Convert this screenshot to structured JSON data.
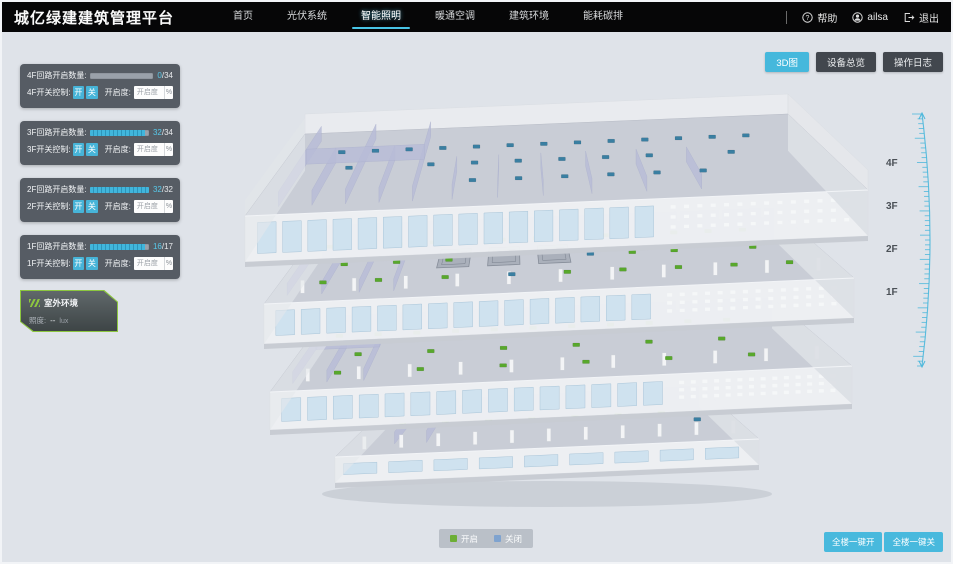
{
  "header": {
    "title": "城亿绿建建筑管理平台",
    "nav": [
      {
        "label": "首页",
        "active": false
      },
      {
        "label": "光伏系统",
        "active": false
      },
      {
        "label": "智能照明",
        "active": true
      },
      {
        "label": "暖通空调",
        "active": false
      },
      {
        "label": "建筑环境",
        "active": false
      },
      {
        "label": "能耗碳排",
        "active": false
      }
    ],
    "help_label": "帮助",
    "username": "ailsa",
    "logout_label": "退出"
  },
  "toolbar": {
    "view_3d": "3D图",
    "device_overview": "设备总览",
    "operation_log": "操作日志"
  },
  "floor_panels": [
    {
      "floor": "4F",
      "count_label": "4F回路开启数量:",
      "value": 0,
      "max": 34,
      "max_text": "/34",
      "switch_label": "4F开关控制:",
      "on_label": "开",
      "off_label": "关",
      "openness_label": "开启度:",
      "openness_placeholder": "开启度",
      "unit": "%"
    },
    {
      "floor": "3F",
      "count_label": "3F回路开启数量:",
      "value": 32,
      "max": 34,
      "max_text": "/34",
      "switch_label": "3F开关控制:",
      "on_label": "开",
      "off_label": "关",
      "openness_label": "开启度:",
      "openness_placeholder": "开启度",
      "unit": "%"
    },
    {
      "floor": "2F",
      "count_label": "2F回路开启数量:",
      "value": 32,
      "max": 32,
      "max_text": "/32",
      "switch_label": "2F开关控制:",
      "on_label": "开",
      "off_label": "关",
      "openness_label": "开启度:",
      "openness_placeholder": "开启度",
      "unit": "%"
    },
    {
      "floor": "1F",
      "count_label": "1F回路开启数量:",
      "value": 16,
      "max": 17,
      "max_text": "/17",
      "switch_label": "1F开关控制:",
      "on_label": "开",
      "off_label": "关",
      "openness_label": "开启度:",
      "openness_placeholder": "开启度",
      "unit": "%"
    }
  ],
  "outdoor": {
    "title": "室外环境",
    "illuminance_label": "照度:",
    "illuminance_value": "--",
    "illuminance_unit": "lux"
  },
  "floor_selector": [
    "4F",
    "3F",
    "2F",
    "1F"
  ],
  "legend": {
    "on_label": "开启",
    "off_label": "关闭",
    "on_color": "#6cae35",
    "off_color": "#7fa3cf"
  },
  "bulk_actions": {
    "all_on": "全楼一键开",
    "all_off": "全楼一键关"
  },
  "colors": {
    "accent": "#45b8dc",
    "header_bg": "#060607",
    "page_bg": "#dfe3e9",
    "panel_bg": "rgba(71,77,85,0.9)"
  },
  "building": {
    "light_on_color": "#58a82c",
    "light_off_color": "#3a7fa2",
    "floors": [
      {
        "name": "4F",
        "lights": [
          [
            0.1,
            0.75,
            0
          ],
          [
            0.165,
            0.75,
            0
          ],
          [
            0.23,
            0.75,
            0
          ],
          [
            0.295,
            0.75,
            0
          ],
          [
            0.36,
            0.75,
            0
          ],
          [
            0.425,
            0.75,
            0
          ],
          [
            0.49,
            0.75,
            0
          ],
          [
            0.555,
            0.75,
            0
          ],
          [
            0.62,
            0.75,
            0
          ],
          [
            0.685,
            0.75,
            0
          ],
          [
            0.75,
            0.75,
            0
          ],
          [
            0.815,
            0.75,
            0
          ],
          [
            0.88,
            0.75,
            0
          ],
          [
            0.13,
            0.55,
            0
          ],
          [
            0.28,
            0.55,
            0
          ],
          [
            0.36,
            0.55,
            0
          ],
          [
            0.44,
            0.55,
            0
          ],
          [
            0.52,
            0.55,
            0
          ],
          [
            0.6,
            0.55,
            0
          ],
          [
            0.68,
            0.55,
            0
          ],
          [
            0.83,
            0.55,
            0
          ],
          [
            0.36,
            0.33,
            0
          ],
          [
            0.44,
            0.33,
            0
          ],
          [
            0.52,
            0.33,
            0
          ],
          [
            0.6,
            0.33,
            0
          ],
          [
            0.68,
            0.33,
            0
          ],
          [
            0.76,
            0.33,
            0
          ]
        ]
      },
      {
        "name": "3F",
        "lights": [
          [
            0.05,
            0.72,
            1
          ],
          [
            0.12,
            0.72,
            1
          ],
          [
            0.19,
            0.72,
            1
          ],
          [
            0.26,
            0.72,
            1
          ],
          [
            0.33,
            0.72,
            1
          ],
          [
            0.4,
            0.72,
            1
          ],
          [
            0.47,
            0.72,
            1
          ],
          [
            0.54,
            0.72,
            1
          ],
          [
            0.61,
            0.72,
            1
          ],
          [
            0.68,
            0.72,
            1
          ],
          [
            0.75,
            0.72,
            1
          ],
          [
            0.82,
            0.72,
            1
          ],
          [
            0.89,
            0.72,
            1
          ],
          [
            0.1,
            0.48,
            1
          ],
          [
            0.2,
            0.48,
            1
          ],
          [
            0.3,
            0.48,
            1
          ],
          [
            0.57,
            0.48,
            0
          ],
          [
            0.65,
            0.48,
            1
          ],
          [
            0.73,
            0.48,
            1
          ],
          [
            0.88,
            0.48,
            1
          ],
          [
            0.08,
            0.25,
            1
          ],
          [
            0.18,
            0.25,
            1
          ],
          [
            0.3,
            0.25,
            1
          ],
          [
            0.42,
            0.25,
            0
          ],
          [
            0.52,
            0.25,
            1
          ],
          [
            0.62,
            0.25,
            1
          ],
          [
            0.72,
            0.25,
            1
          ],
          [
            0.82,
            0.25,
            1
          ],
          [
            0.92,
            0.25,
            1
          ]
        ]
      },
      {
        "name": "2F",
        "lights": [
          [
            0.06,
            0.72,
            1
          ],
          [
            0.14,
            0.72,
            1
          ],
          [
            0.22,
            0.72,
            1
          ],
          [
            0.3,
            0.72,
            1
          ],
          [
            0.38,
            0.72,
            1
          ],
          [
            0.46,
            0.72,
            1
          ],
          [
            0.54,
            0.72,
            1
          ],
          [
            0.62,
            0.72,
            1
          ],
          [
            0.7,
            0.72,
            1
          ],
          [
            0.78,
            0.72,
            1
          ],
          [
            0.86,
            0.72,
            1
          ],
          [
            0.12,
            0.46,
            1
          ],
          [
            0.26,
            0.46,
            1
          ],
          [
            0.4,
            0.46,
            1
          ],
          [
            0.54,
            0.46,
            1
          ],
          [
            0.68,
            0.46,
            1
          ],
          [
            0.82,
            0.46,
            1
          ],
          [
            0.1,
            0.22,
            1
          ],
          [
            0.25,
            0.22,
            1
          ],
          [
            0.4,
            0.22,
            1
          ],
          [
            0.55,
            0.22,
            1
          ],
          [
            0.7,
            0.22,
            1
          ],
          [
            0.85,
            0.22,
            1
          ]
        ]
      },
      {
        "name": "1F",
        "lights": [
          [
            0.1,
            0.55,
            1
          ],
          [
            0.22,
            0.55,
            1
          ],
          [
            0.34,
            0.55,
            1
          ],
          [
            0.46,
            0.55,
            1
          ],
          [
            0.58,
            0.55,
            1
          ],
          [
            0.7,
            0.55,
            1
          ],
          [
            0.82,
            0.55,
            1
          ],
          [
            0.06,
            0.75,
            1
          ],
          [
            0.9,
            0.4,
            0
          ]
        ]
      }
    ]
  }
}
